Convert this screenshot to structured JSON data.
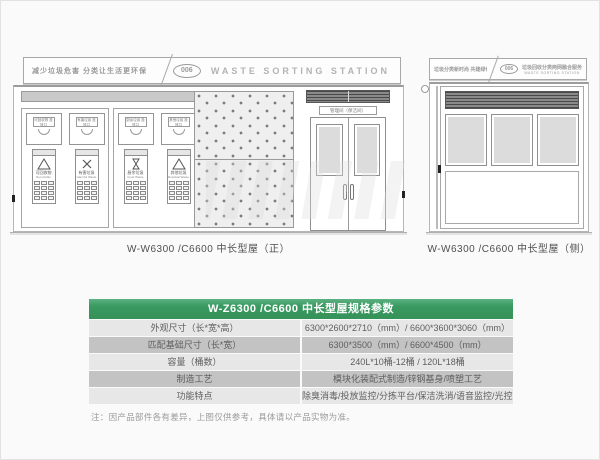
{
  "front_view": {
    "banner": {
      "slogan": "减少垃圾危害 分类让生活更环保",
      "number": "006",
      "title": "WASTE SORTING STATION"
    },
    "door_sign": "管理间（保洁间）",
    "units": [
      {
        "port_label": "可回收物 投放口",
        "name_cn": "可回收物",
        "name_en": "Recyclable"
      },
      {
        "port_label": "有害垃圾 投放口",
        "name_cn": "有害垃圾",
        "name_en": "Harmful Waste"
      },
      {
        "port_label": "厨余垃圾 投放口",
        "name_cn": "厨余垃圾",
        "name_en": "Food Waste"
      },
      {
        "port_label": "其他垃圾 投放口",
        "name_cn": "其他垃圾",
        "name_en": "Residual Waste"
      }
    ],
    "caption": "W-W6300 /C6600 中长型屋（正）"
  },
  "side_view": {
    "banner": {
      "slogan": "垃圾分类新时尚 共建绿色新家园",
      "number": "006",
      "title_cn": "垃圾回收分类两网融合服务",
      "title_en": "WASTE SORTING STATION"
    },
    "caption": "W-W6300 /C6600 中长型屋（侧）"
  },
  "spec_table": {
    "title": "W-Z6300 /C6600 中长型屋规格参数",
    "rows": [
      {
        "label": "外观尺寸（长*宽*高）",
        "value": "6300*2600*2710（mm）/ 6600*3600*3060（mm）"
      },
      {
        "label": "匹配基础尺寸（长*宽）",
        "value": "6300*3500（mm）/ 6600*4500（mm）"
      },
      {
        "label": "容量（桶数）",
        "value": "240L*10桶-12桶 / 120L*18桶"
      },
      {
        "label": "制造工艺",
        "value": "模块化装配式制造/锌钢基身/喷塑工艺"
      },
      {
        "label": "功能特点",
        "value": "除臭消毒/投放监控/分拣平台/保洁洗消/语音监控/光控照明"
      }
    ],
    "note": "注：因产品部件各有差异，上图仅供参考，具体请以产品实物为准。"
  },
  "colors": {
    "table_header_green": "#3a9a62",
    "row_light": "#e7e7e7",
    "row_dark": "#c3c3c3"
  }
}
